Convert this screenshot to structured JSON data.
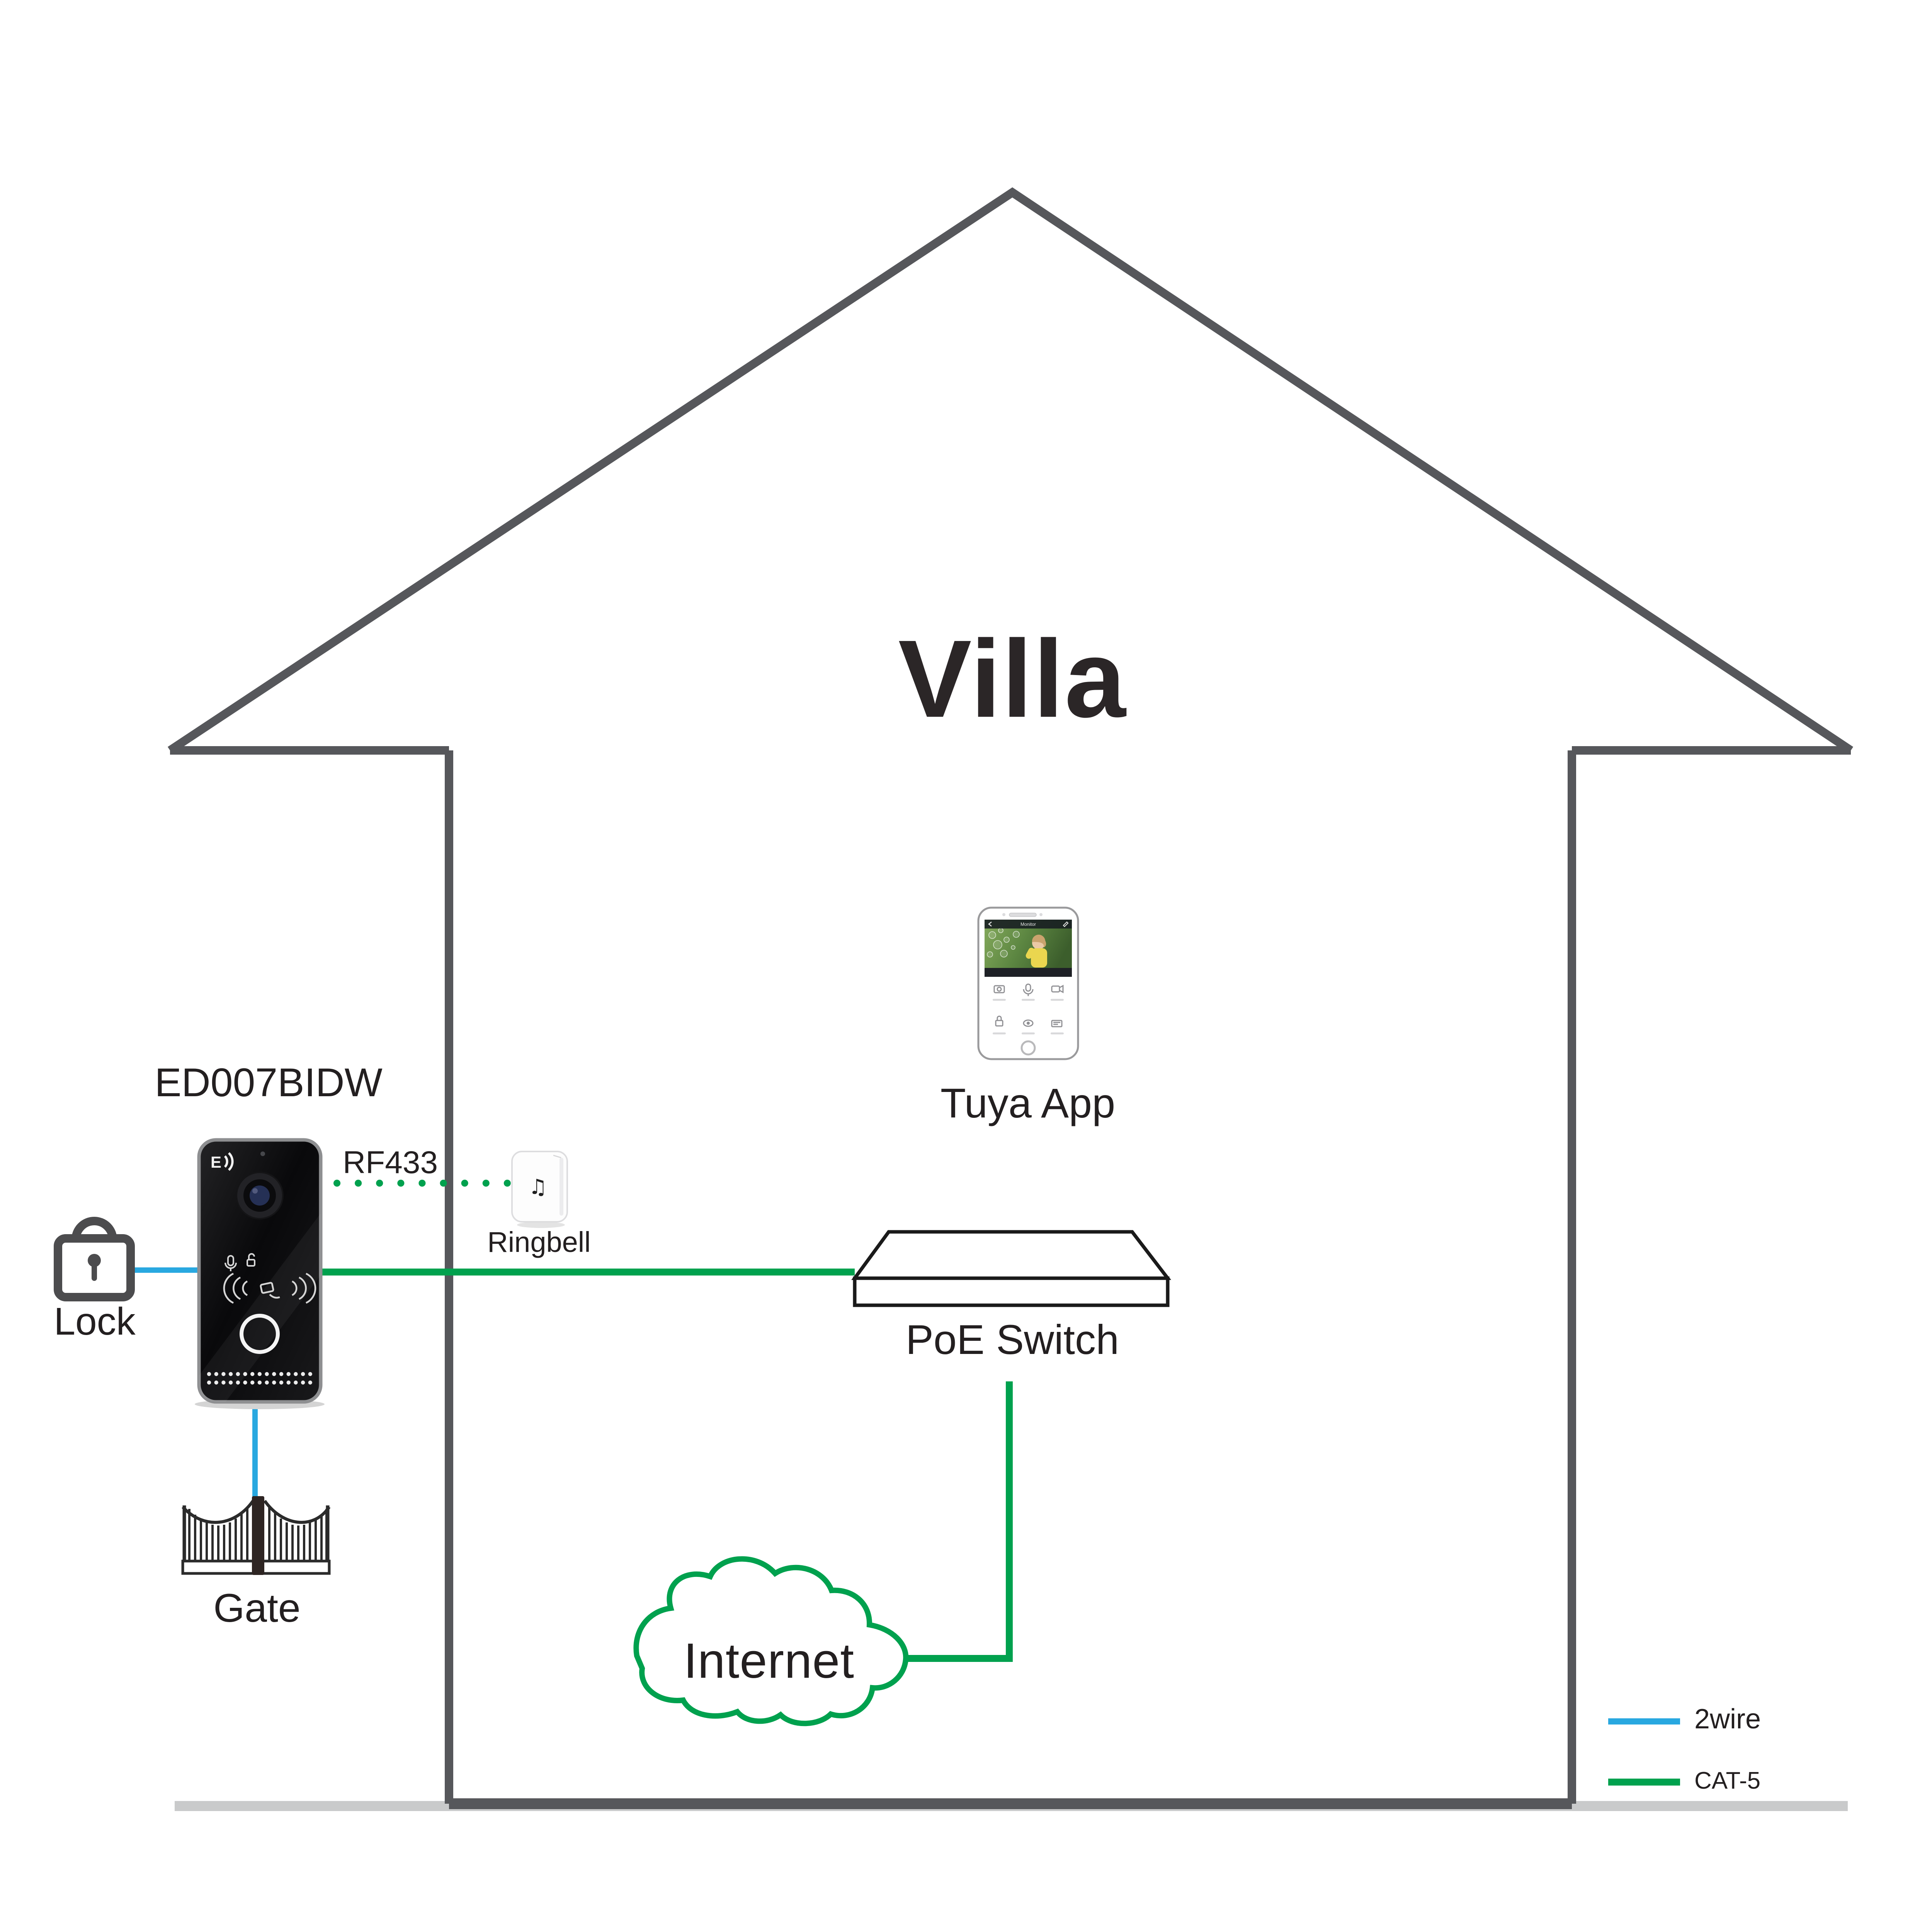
{
  "title": {
    "text": "Villa"
  },
  "doorbell": {
    "label": "ED007BIDW"
  },
  "rf": {
    "label": "RF433"
  },
  "ringbell": {
    "label": "Ringbell",
    "note_icon": "♫"
  },
  "lock": {
    "label": "Lock"
  },
  "gate": {
    "label": "Gate"
  },
  "phone": {
    "label": "Tuya App",
    "screen_title": "Monitor"
  },
  "poe": {
    "label": "PoE Switch"
  },
  "internet": {
    "label": "Internet"
  },
  "legend": {
    "items": [
      {
        "label": "2wire",
        "color": "#29a8e0"
      },
      {
        "label": "CAT-5",
        "color": "#00a14e"
      }
    ]
  },
  "colors": {
    "wire2_blue": "#29a8e0",
    "cat5_green": "#00a14e",
    "house_outline": "#56575b",
    "floor_gray": "#c9cacb",
    "text": "#231f20"
  }
}
